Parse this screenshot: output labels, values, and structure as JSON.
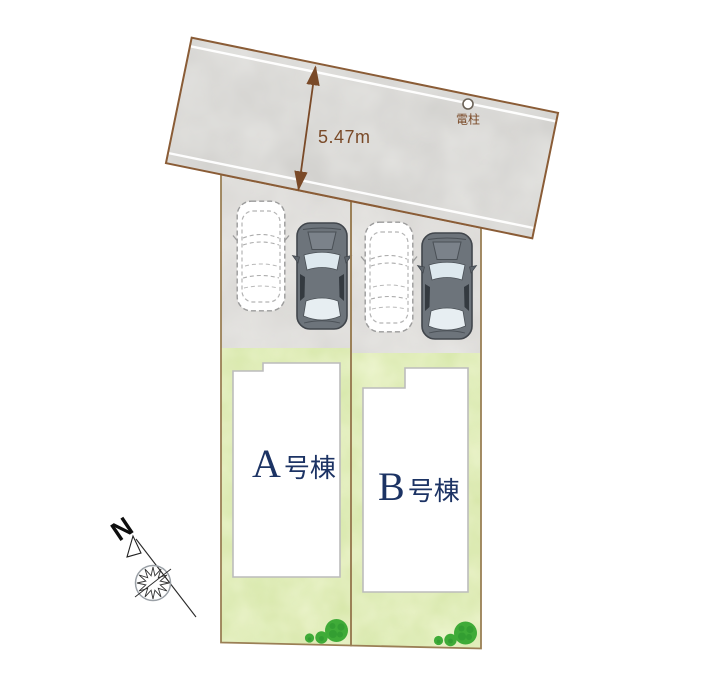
{
  "plan": {
    "road": {
      "width_label": "5.47m",
      "utility_pole_label": "電柱"
    },
    "lots": [
      {
        "name": "A",
        "building_letter": "A",
        "building_suffix": "号棟"
      },
      {
        "name": "B",
        "building_letter": "B",
        "building_suffix": "号棟"
      }
    ],
    "compass": {
      "north_label": "N"
    },
    "colors": {
      "road_fill": "#cfcecb",
      "road_border": "#8a5c36",
      "parking_fill": "#d8d6d3",
      "lot_border": "#9a7f55",
      "lawn_fill": "#d4e4a3",
      "building_fill": "#ffffff",
      "building_label": "#1c3364",
      "dimension": "#7a4a28",
      "bush_green": "#3fab38",
      "car_body": "#6d747b",
      "lane_line": "#ffffff"
    }
  }
}
